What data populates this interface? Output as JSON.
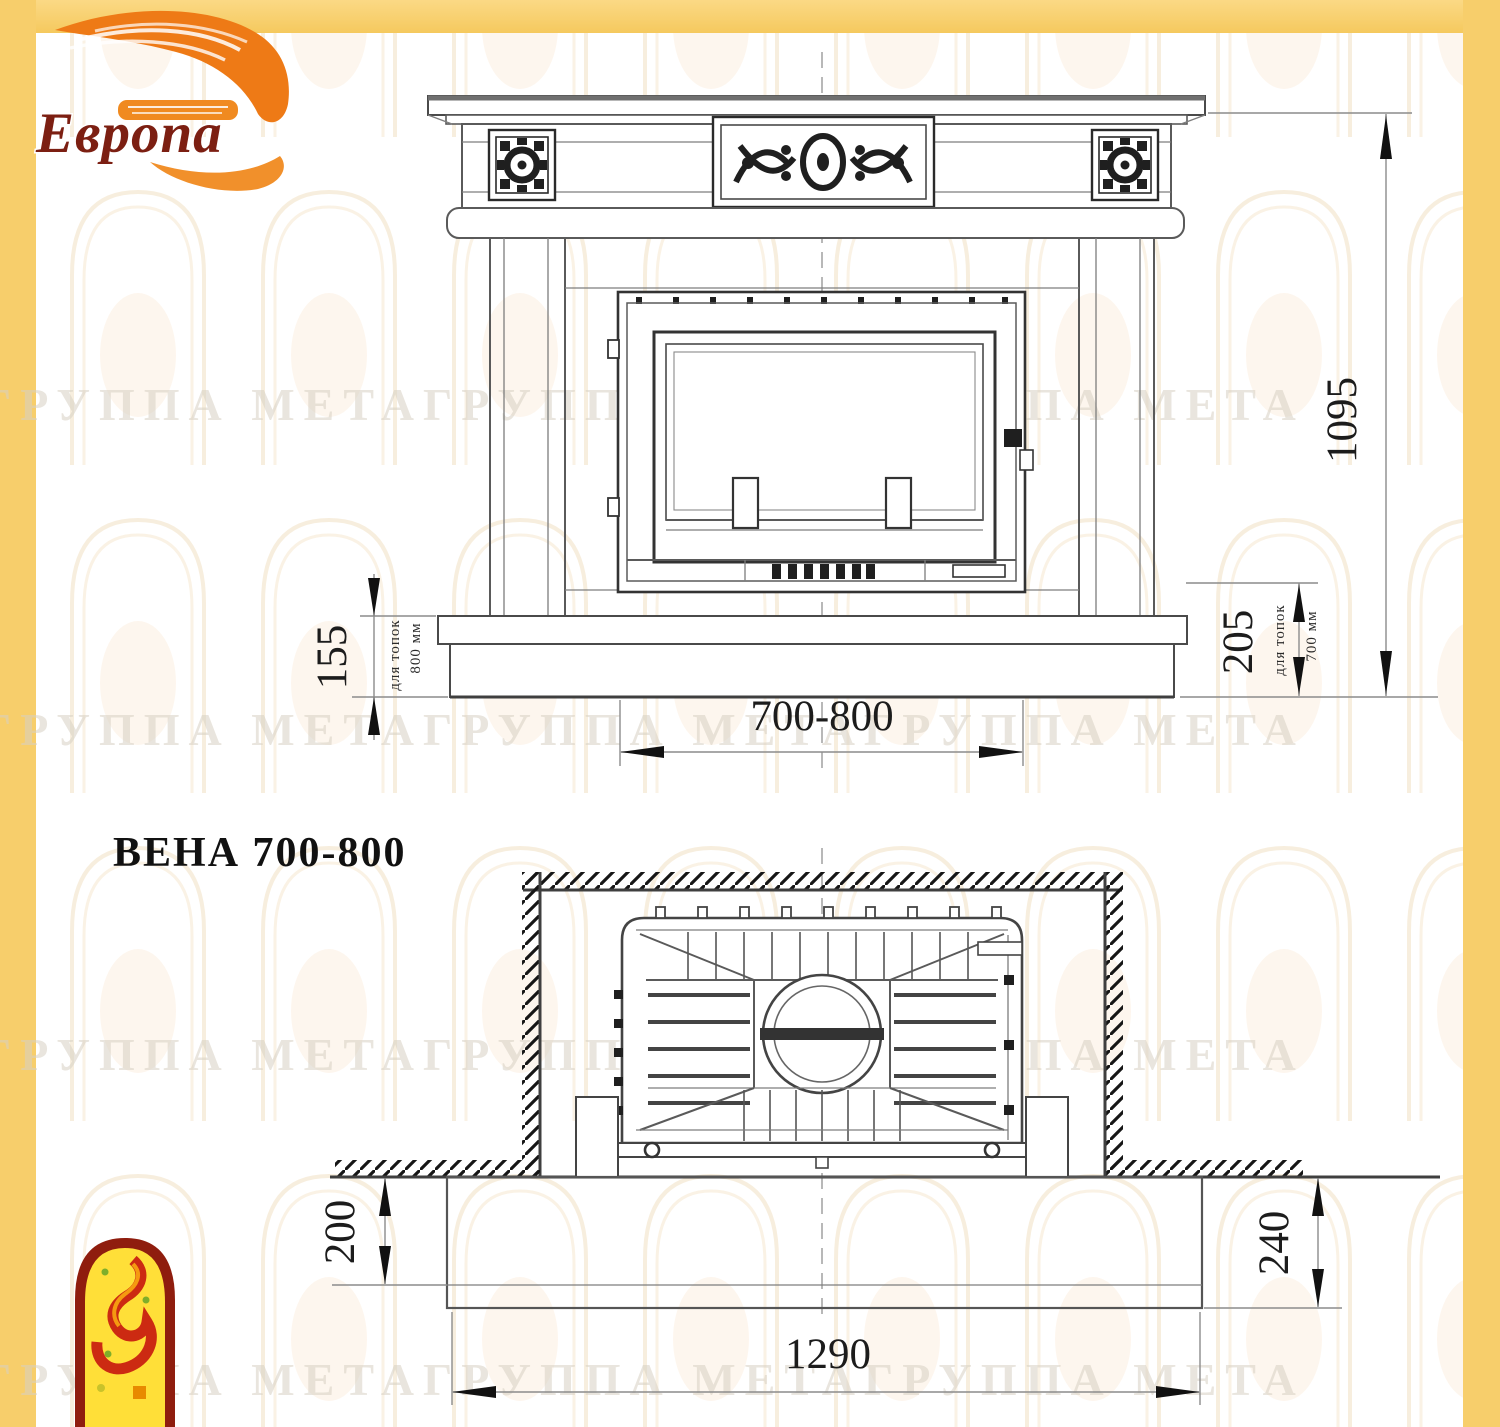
{
  "brand": {
    "name": "Европа"
  },
  "title": "ВЕНА 700-800",
  "watermark": {
    "text": "ГРУППА МЕТАГРУППА МЕТАГРУППА МЕТА"
  },
  "front_view": {
    "overall_height": "1095",
    "hearth_height_800": "155",
    "hearth_note_800_line1": "для топок",
    "hearth_note_800_line2": "800 мм",
    "hearth_height_700": "205",
    "hearth_note_700_line1": "для топок",
    "hearth_note_700_line2": "700 мм",
    "firebox_width": "700-800"
  },
  "plan_view": {
    "hearth_depth_left": "200",
    "hearth_depth_right": "240",
    "hearth_width": "1290"
  },
  "colors": {
    "accent_yellow": "#f7ce6b",
    "logo_orange": "#ee7a16",
    "logo_text_red": "#7c1f12",
    "icon_border_red": "#8f1d0e",
    "icon_fill_yellow": "#ffdf38",
    "drawing_line": "#5a5a5a",
    "dimension_text": "#1c1c1c"
  }
}
